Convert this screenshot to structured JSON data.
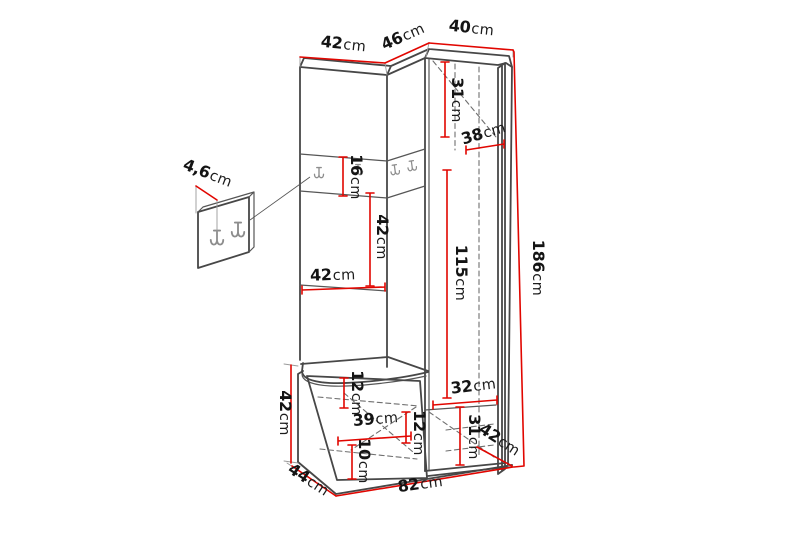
{
  "page": {
    "background": "#ffffff",
    "accent_red": "#e10600",
    "outline_color": "#474747",
    "description": "Dimension diagram of a corner hallway wardrobe unit with coat hook rail, open-door cabinet, shoe bench and a wall hook panel detail"
  },
  "diagram": {
    "unit_of_measure": "cm",
    "dimensions": [
      {
        "id": "top-left-section-width",
        "value": "42",
        "unit": "cm"
      },
      {
        "id": "corner-section-width",
        "value": "46",
        "unit": "cm"
      },
      {
        "id": "right-section-width",
        "value": "40",
        "unit": "cm"
      },
      {
        "id": "upper-cabinet-inner-height",
        "value": "31",
        "unit": "cm"
      },
      {
        "id": "cabinet-inner-width",
        "value": "38",
        "unit": "cm"
      },
      {
        "id": "hook-rail-height",
        "value": "16",
        "unit": "cm"
      },
      {
        "id": "middle-gap-height",
        "value": "42",
        "unit": "cm"
      },
      {
        "id": "middle-shelf-width",
        "value": "42",
        "unit": "cm"
      },
      {
        "id": "door-inner-height",
        "value": "115",
        "unit": "cm"
      },
      {
        "id": "total-height",
        "value": "186",
        "unit": "cm"
      },
      {
        "id": "hook-panel-depth",
        "value": "4,6",
        "unit": "cm"
      },
      {
        "id": "lower-right-inner-width",
        "value": "32",
        "unit": "cm"
      },
      {
        "id": "lower-right-inner-height",
        "value": "31",
        "unit": "cm"
      },
      {
        "id": "right-side-depth",
        "value": "42",
        "unit": "cm"
      },
      {
        "id": "seat-to-shelf-height",
        "value": "12",
        "unit": "cm"
      },
      {
        "id": "bench-inner-width",
        "value": "39",
        "unit": "cm"
      },
      {
        "id": "bench-shelf-gap-height",
        "value": "12",
        "unit": "cm"
      },
      {
        "id": "bench-bottom-gap-height",
        "value": "10",
        "unit": "cm"
      },
      {
        "id": "bench-height",
        "value": "42",
        "unit": "cm"
      },
      {
        "id": "left-side-depth",
        "value": "44",
        "unit": "cm"
      },
      {
        "id": "total-width",
        "value": "82",
        "unit": "cm"
      }
    ],
    "icons": [
      {
        "name": "coat-hook-icon",
        "count_on_rail": 4,
        "count_on_panel_detail": 2
      }
    ]
  }
}
